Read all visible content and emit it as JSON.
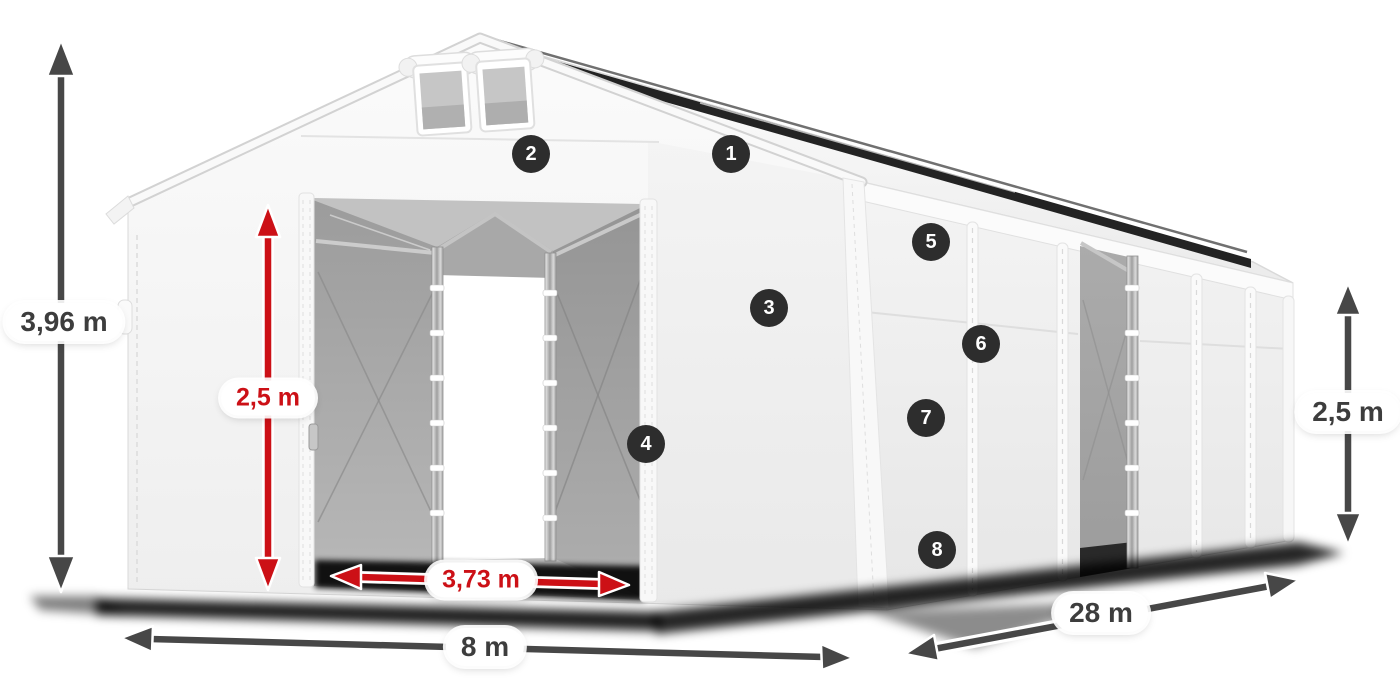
{
  "colors": {
    "accent_red": "#cc1016",
    "dim_text": "#3d3d3d",
    "badge_bg": "#2d2d2d",
    "badge_text": "#ffffff",
    "label_bg": "#ffffff"
  },
  "diagram": {
    "alt": "White storage tent shown in three-quarter view with open front doors and dimension arrows",
    "dimensions": [
      {
        "id": "total-height",
        "text": "3,96 m",
        "style": "gray"
      },
      {
        "id": "door-height",
        "text": "2,5 m",
        "style": "red"
      },
      {
        "id": "door-width",
        "text": "3,73 m",
        "style": "red"
      },
      {
        "id": "front-width",
        "text": "8 m",
        "style": "gray"
      },
      {
        "id": "side-length",
        "text": "28 m",
        "style": "gray"
      },
      {
        "id": "side-height",
        "text": "2,5 m",
        "style": "gray"
      }
    ],
    "markers": [
      {
        "number": "1"
      },
      {
        "number": "2"
      },
      {
        "number": "3"
      },
      {
        "number": "4"
      },
      {
        "number": "5"
      },
      {
        "number": "6"
      },
      {
        "number": "7"
      },
      {
        "number": "8"
      }
    ]
  }
}
